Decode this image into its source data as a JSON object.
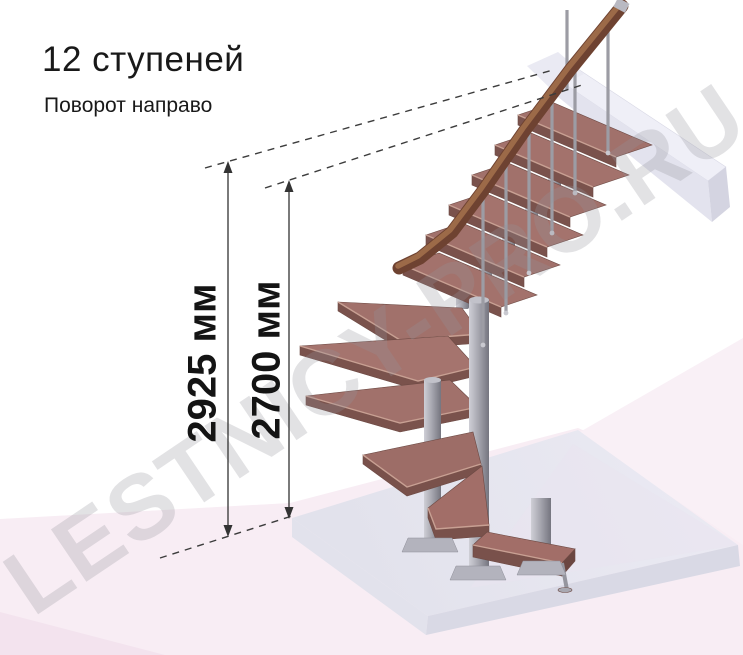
{
  "header": {
    "title": "12 ступеней",
    "subtitle": "Поворот направо"
  },
  "dimensions": {
    "total_height": {
      "label": "2925 мм",
      "value": 2925,
      "unit": "мм"
    },
    "height_to_top_step": {
      "label": "2700 мм",
      "value": 2700,
      "unit": "мм"
    }
  },
  "watermark": {
    "text": "LESTNICY-PRO.RU"
  },
  "colors": {
    "background": "#ffffff",
    "floor_pink": "#f8edf4",
    "floor_pink_deep": "#f3e3ee",
    "wall_pink": "#f9f0f6",
    "slab_top": "#e6e6f0",
    "slab_side": "#dadae6",
    "beam": "#e9e9f3",
    "tread_top": "#a1716b",
    "tread_front": "#7a524c",
    "handrail_dark": "#6e4231",
    "handrail_light": "#9c6a48",
    "metal_light": "#cfcfd6",
    "metal_mid": "#a8a8b1",
    "metal_dark": "#75757f",
    "dimension_line": "#333333",
    "text": "#191919",
    "watermark_gray": "#c9c9d1"
  }
}
